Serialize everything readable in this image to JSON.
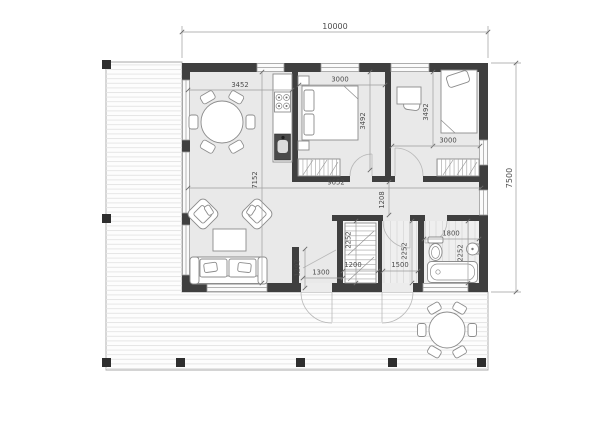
{
  "colors": {
    "wall": "#3f3f3f",
    "floor": "#e9e9e9",
    "deck_bg": "#fdfdfd",
    "deck_line": "#e3e3e3",
    "outline": "#a8a8a8",
    "furniture_line": "#8c8c8c",
    "post": "#2e2e2e",
    "dim_line": "#9c9c9c",
    "dim_text": "#4c4c4c",
    "tile_line": "#d8d8d8"
  },
  "dimensions": {
    "overall_width": "10000",
    "overall_height": "7500",
    "dining_width": "3452",
    "bedroom1_width": "3000",
    "bedroom1_depth": "3492",
    "bedroom2_depth": "3492",
    "bedroom2_width": "3000",
    "greatroom_depth": "7152",
    "interior_width": "9652",
    "corridor_width": "1208",
    "closet_depth": "2252",
    "closet_width": "1200",
    "hall_width": "1500",
    "hall_depth": "2252",
    "bath_width": "1800",
    "bath_depth": "2252",
    "entry_partition": "1297",
    "entry_width": "1300"
  }
}
